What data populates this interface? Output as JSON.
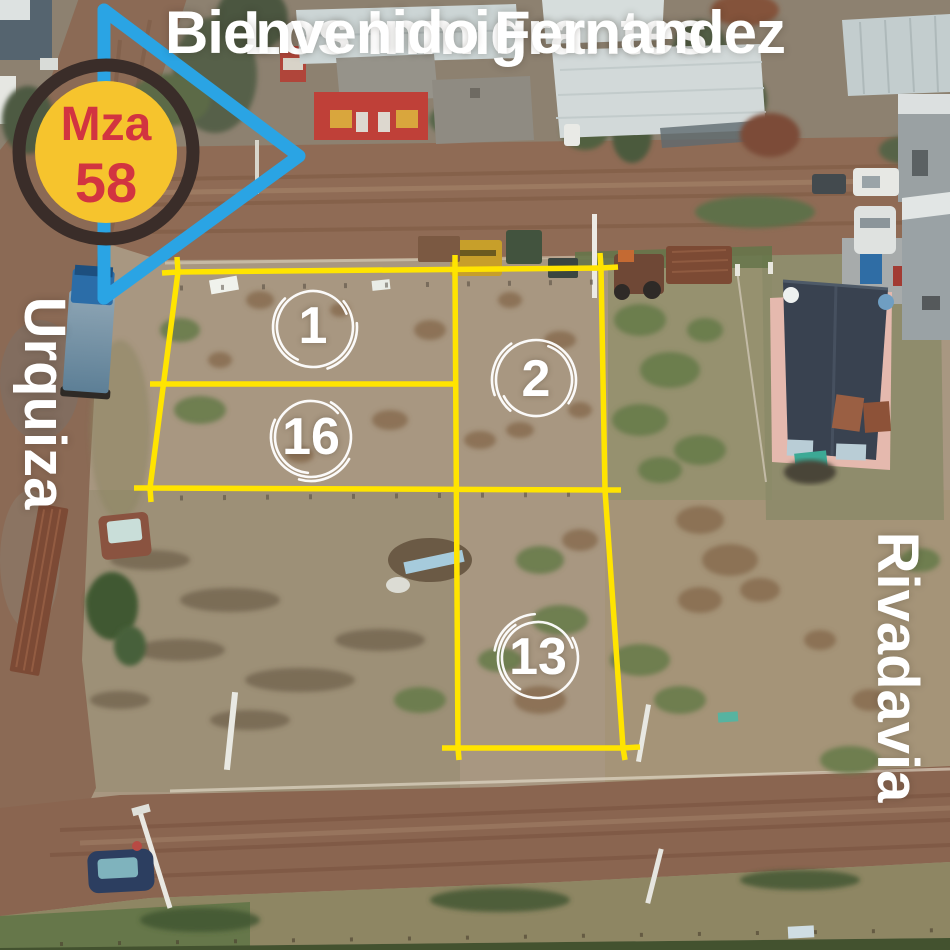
{
  "badge": {
    "line1": "Mza",
    "line2": "58"
  },
  "streets": {
    "top": "Los Inmigrantes",
    "left": "Urquiza",
    "right": "Rivadavia",
    "bottom": "Bienvenido Fernandez"
  },
  "lots": [
    {
      "label": "1"
    },
    {
      "label": "2"
    },
    {
      "label": "16"
    },
    {
      "label": "13"
    }
  ],
  "colors": {
    "lot_line": "#FFE400",
    "arrow": "#2AA4E4",
    "badge_fill": "#F6C42D",
    "badge_ring": "#3A2D29",
    "badge_text": "#D23440",
    "street_text": "#FFFFFF",
    "lot_number_text": "#FFFFFF",
    "sketch_circle": "#FFFFFF"
  }
}
